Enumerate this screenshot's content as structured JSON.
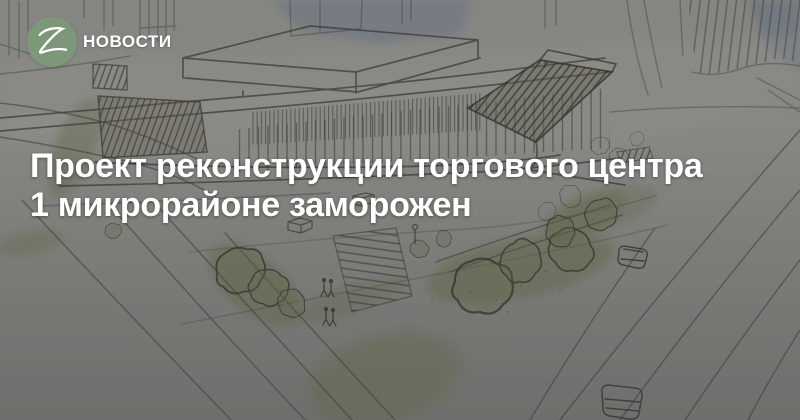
{
  "brand": {
    "section_label": "НОВОСТИ",
    "logo_letter": "Z",
    "logo_color": "#7c9878"
  },
  "headline": {
    "line1": "Проект реконструкции торгового центра",
    "line2": "1 микрорайоне заморожен"
  },
  "image": {
    "description": "Архитектурный эскиз торгового центра: здание с ламелями на фасаде, деревья, дороги, автомобили, пешеходы",
    "overlay_color": "rgba(51,51,51,0.45)"
  },
  "colors": {
    "headline_text": "#ffffff",
    "brand_text": "#ffffff",
    "sketch_paper": "#8b8b85",
    "sketch_line": "#3e3e38",
    "sketch_green": "#6f7550",
    "sketch_sky": "#79818c"
  }
}
